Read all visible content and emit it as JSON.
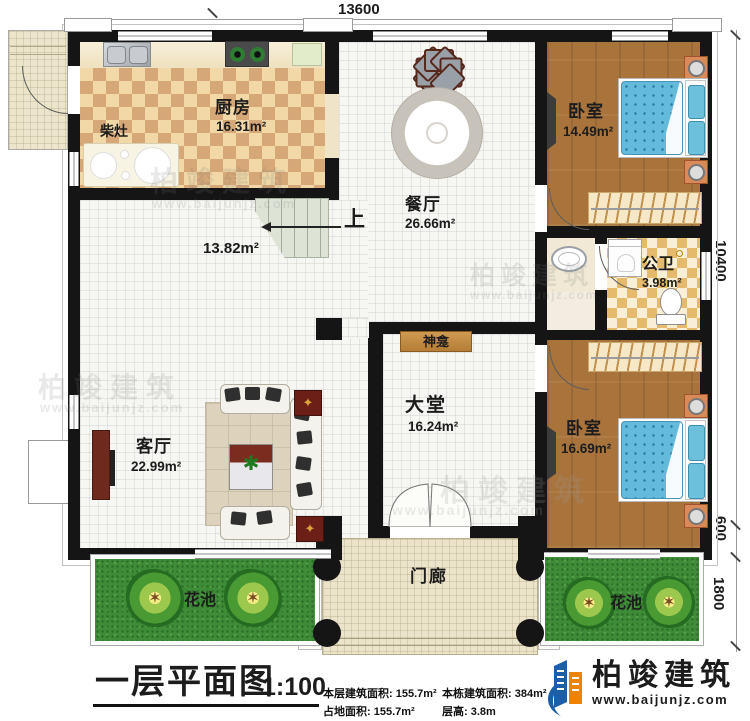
{
  "dimensions": {
    "top": "13600",
    "right_upper": "10400",
    "right_mid": "600",
    "right_lower": "1800"
  },
  "rooms": {
    "kitchen": {
      "name": "厨房",
      "area": "16.31m²"
    },
    "wood_stove": "柴灶",
    "dining": {
      "name": "餐厅",
      "area": "26.66m²"
    },
    "bedroom_top": {
      "name": "卧室",
      "area": "14.49m²"
    },
    "bathroom": {
      "name": "公卫",
      "area": "3.98m²"
    },
    "bedroom_bottom": {
      "name": "卧室",
      "area": "16.69m²"
    },
    "hall": {
      "name": "大堂",
      "area": "16.24m²"
    },
    "living": {
      "name": "客厅",
      "area": "22.99m²"
    },
    "corridor_area": "13.82m²",
    "shrine": "神龛",
    "stairs_up": "上",
    "porch": "门廊",
    "flower_bed_left": "花池",
    "flower_bed_right": "花池"
  },
  "footer": {
    "title": "一层平面图",
    "scale": "1:100",
    "stats": [
      {
        "label": "本层建筑面积:",
        "value": "155.7m²"
      },
      {
        "label": "占地面积:",
        "value": "155.7m²"
      },
      {
        "label": "本栋建筑面积:",
        "value": "384m²"
      },
      {
        "label": "层高:",
        "value": "3.8m"
      }
    ],
    "brand": {
      "name": "柏竣建筑",
      "url": "www.baijunjz.com"
    }
  },
  "watermark": {
    "name": "柏竣建筑",
    "url": "www.baijunjz.com"
  },
  "colors": {
    "wall": "#151515",
    "wood_floor": "#a9743c",
    "kitchen_checker": "#d7a877",
    "bath_checker": "#e6ba6c",
    "grass": "#3e8c38",
    "bed": "#64badb",
    "brand_blue": "#1b5fa8",
    "brand_orange": "#ef8200"
  }
}
